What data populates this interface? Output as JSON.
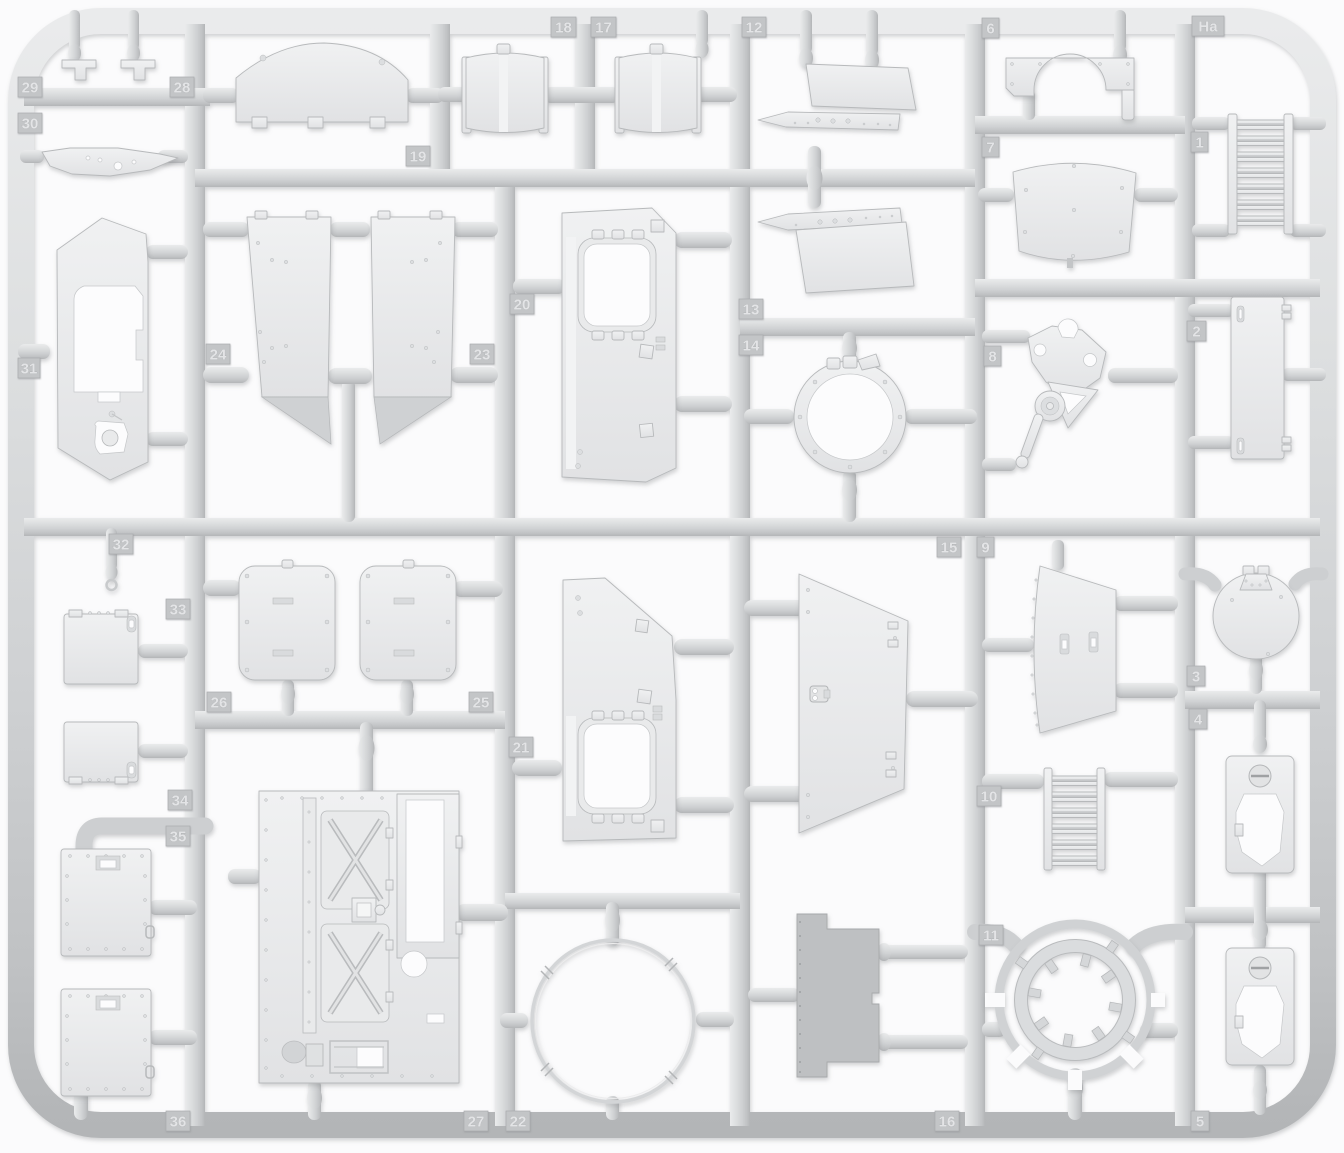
{
  "sprue": {
    "background_color": "#fbfbfc",
    "plastic_color": "#d2d4d6",
    "part_fill_color": "#eaebec",
    "dark_part_color": "#bec0c2",
    "tag_fill_color": "#c3c5c7",
    "tag_text_color": "#e3e4e6",
    "tags": [
      {
        "label": "29",
        "x": 18,
        "y": 77,
        "w": 24
      },
      {
        "label": "28",
        "x": 170,
        "y": 77,
        "w": 24
      },
      {
        "label": "30",
        "x": 18,
        "y": 113,
        "w": 24
      },
      {
        "label": "31",
        "x": 18,
        "y": 358,
        "w": 22
      },
      {
        "label": "19",
        "x": 406,
        "y": 146,
        "w": 24
      },
      {
        "label": "18",
        "x": 551,
        "y": 17,
        "w": 25
      },
      {
        "label": "17",
        "x": 591,
        "y": 17,
        "w": 25
      },
      {
        "label": "12",
        "x": 742,
        "y": 17,
        "w": 24
      },
      {
        "label": "6",
        "x": 982,
        "y": 18,
        "w": 17
      },
      {
        "label": "Ha",
        "x": 1192,
        "y": 16,
        "w": 32
      },
      {
        "label": "7",
        "x": 982,
        "y": 137,
        "w": 17
      },
      {
        "label": "1",
        "x": 1191,
        "y": 132,
        "w": 17
      },
      {
        "label": "24",
        "x": 206,
        "y": 344,
        "w": 24
      },
      {
        "label": "23",
        "x": 470,
        "y": 344,
        "w": 24
      },
      {
        "label": "20",
        "x": 510,
        "y": 294,
        "w": 24
      },
      {
        "label": "13",
        "x": 739,
        "y": 299,
        "w": 24
      },
      {
        "label": "14",
        "x": 739,
        "y": 335,
        "w": 24
      },
      {
        "label": "8",
        "x": 984,
        "y": 346,
        "w": 17
      },
      {
        "label": "2",
        "x": 1187,
        "y": 321,
        "w": 19
      },
      {
        "label": "32",
        "x": 109,
        "y": 534,
        "w": 24
      },
      {
        "label": "15",
        "x": 937,
        "y": 537,
        "w": 24
      },
      {
        "label": "9",
        "x": 977,
        "y": 537,
        "w": 17
      },
      {
        "label": "33",
        "x": 166,
        "y": 599,
        "w": 24
      },
      {
        "label": "26",
        "x": 207,
        "y": 692,
        "w": 24
      },
      {
        "label": "25",
        "x": 469,
        "y": 692,
        "w": 24
      },
      {
        "label": "21",
        "x": 509,
        "y": 737,
        "w": 24
      },
      {
        "label": "3",
        "x": 1187,
        "y": 666,
        "w": 18
      },
      {
        "label": "4",
        "x": 1189,
        "y": 709,
        "w": 18
      },
      {
        "label": "34",
        "x": 168,
        "y": 790,
        "w": 24
      },
      {
        "label": "35",
        "x": 166,
        "y": 826,
        "w": 24
      },
      {
        "label": "10",
        "x": 977,
        "y": 786,
        "w": 24
      },
      {
        "label": "11",
        "x": 979,
        "y": 925,
        "w": 24
      },
      {
        "label": "36",
        "x": 166,
        "y": 1111,
        "w": 24
      },
      {
        "label": "27",
        "x": 464,
        "y": 1111,
        "w": 24
      },
      {
        "label": "22",
        "x": 506,
        "y": 1111,
        "w": 24
      },
      {
        "label": "16",
        "x": 935,
        "y": 1111,
        "w": 24
      },
      {
        "label": "5",
        "x": 1191,
        "y": 1111,
        "w": 18
      }
    ]
  }
}
